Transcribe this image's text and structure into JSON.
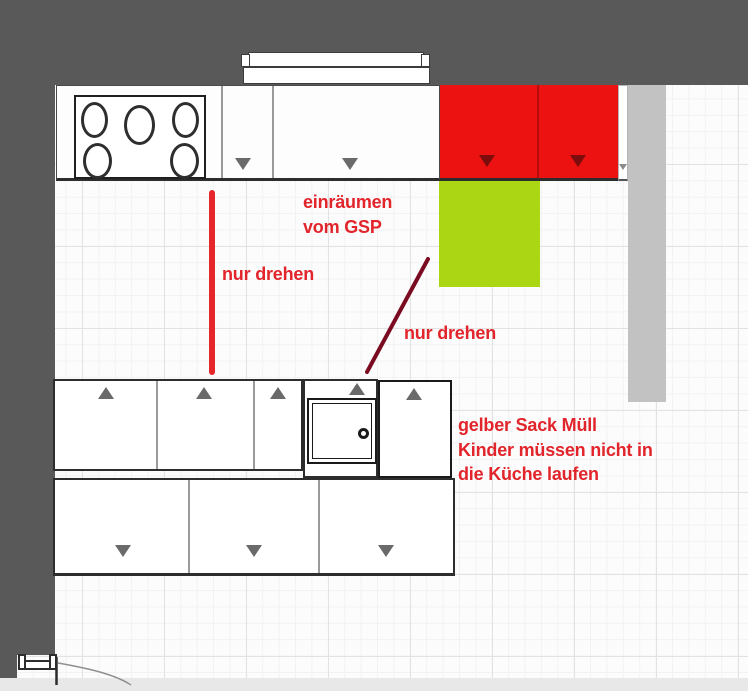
{
  "plan_title": "kitchen floor plan with handwritten notes",
  "annotations": {
    "gsp": {
      "line1": "einräumen",
      "line2": "vom GSP"
    },
    "turn1": "nur drehen",
    "turn2": "nur drehen",
    "note": {
      "line1": "gelber Sack Müll",
      "line2": "Kinder müssen nicht in",
      "line3": "die Küche laufen"
    }
  },
  "colors": {
    "wall": "#595959",
    "annotation_red": "#e2242b",
    "marker_line_red": "#e5262b",
    "marker_line_dark_red": "#7a0b20",
    "cabinet_highlight_red": "#ec1212",
    "cabinet_red_triangle": "#7d0c0c",
    "highlight_green": "#aad614",
    "column_gray": "#c2c2c2",
    "door_triangle_gray": "#6a6a6a",
    "floor_grid": "#f2f2f2"
  }
}
